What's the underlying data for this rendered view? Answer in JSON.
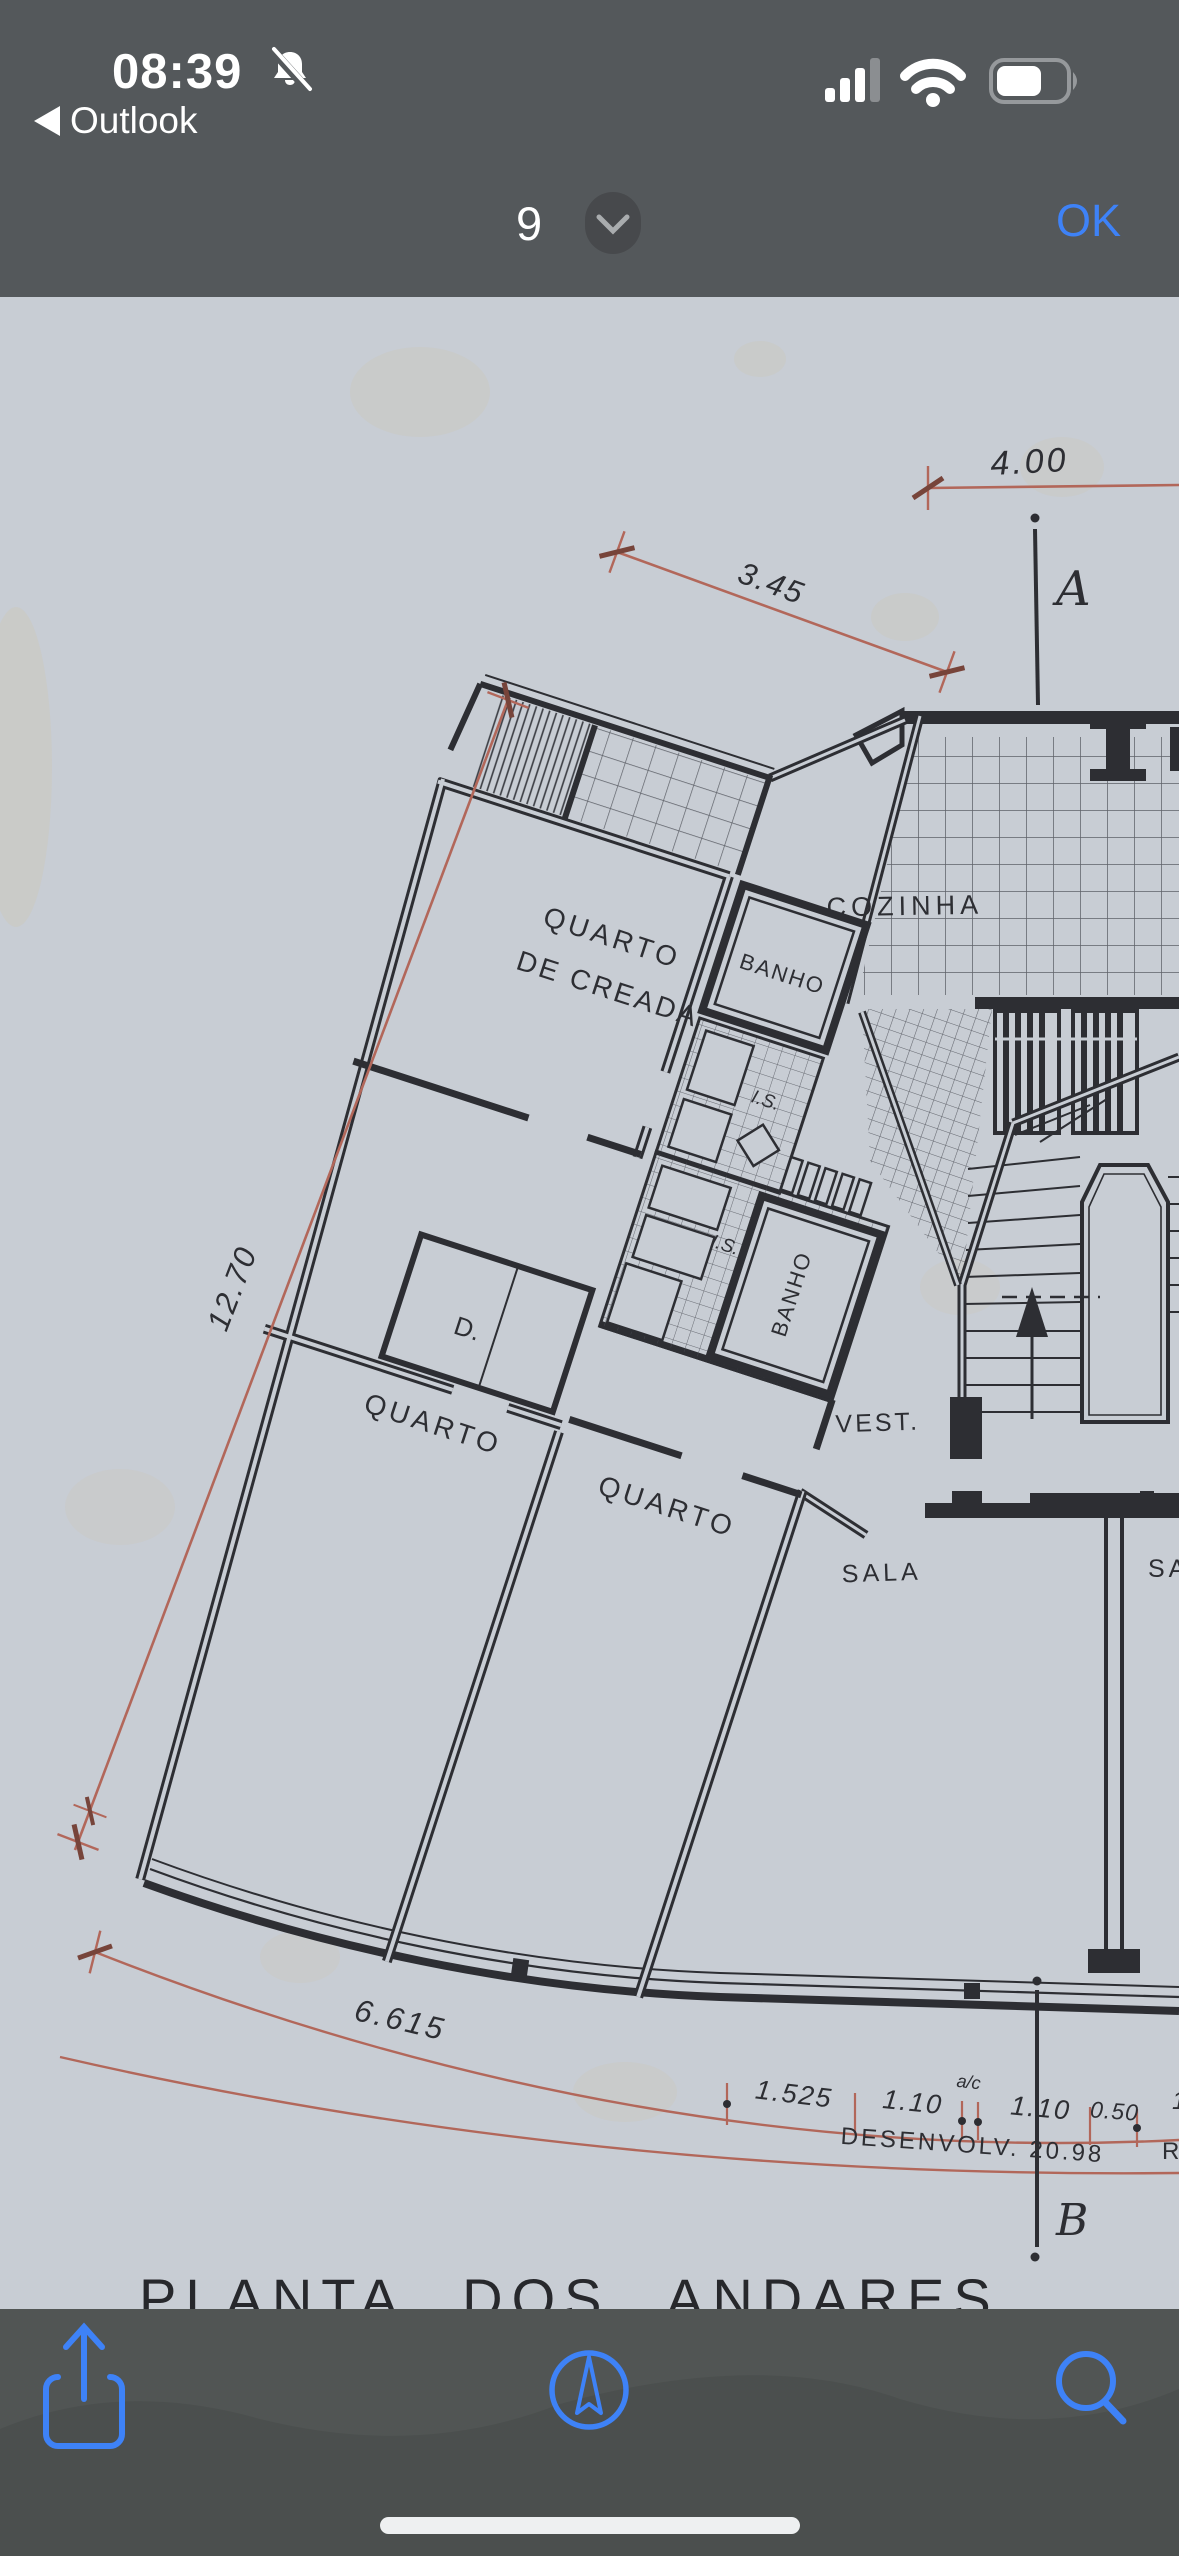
{
  "status_bar": {
    "time": "08:39",
    "back_label": "Outlook",
    "icons": [
      "bell-slash",
      "cellular-signal",
      "wifi",
      "battery"
    ],
    "signal_bars_lit": 3,
    "signal_bars_total": 4
  },
  "nav_bar": {
    "page_number": "9",
    "confirm_label": "OK",
    "accent_color": "#3e82f7"
  },
  "drawing": {
    "title": "PLANTA  DOS  ANDARES",
    "paper_color": "#c8cdd4",
    "ink_color": "#2d2e33",
    "dim_color": "#b2675a",
    "labels": {
      "quarto_creada_1": "QUARTO",
      "quarto_creada_2": "DE CREADA",
      "cozinha": "COZINHA",
      "banho_upper": "BANHO",
      "banho_lower": "BANHO",
      "is_upper": "I.S.",
      "is_lower": "I.S.",
      "d_closet": "D.",
      "quarto_left": "QUARTO",
      "quarto_mid": "QUARTO",
      "vest": "VEST.",
      "sala": "SALA",
      "sala_partial": "SA"
    },
    "dimensions": {
      "top": "4.00",
      "terrace_diag": "3.45",
      "left_diag": "12.70",
      "bottom_left": "6.615",
      "seg_a": "1.525",
      "seg_b": "1.10",
      "seg_ac": "a/c",
      "seg_c": "1.10",
      "seg_d": "0.50",
      "seg_e": "1",
      "developed": "DESENVOLV.  20.98",
      "partial_right": "R"
    },
    "axis_marks": {
      "top": "A",
      "bottom": "B"
    }
  },
  "toolbar": {
    "icons": [
      "share",
      "compass",
      "search"
    ],
    "accent_color": "#3e82f7"
  }
}
